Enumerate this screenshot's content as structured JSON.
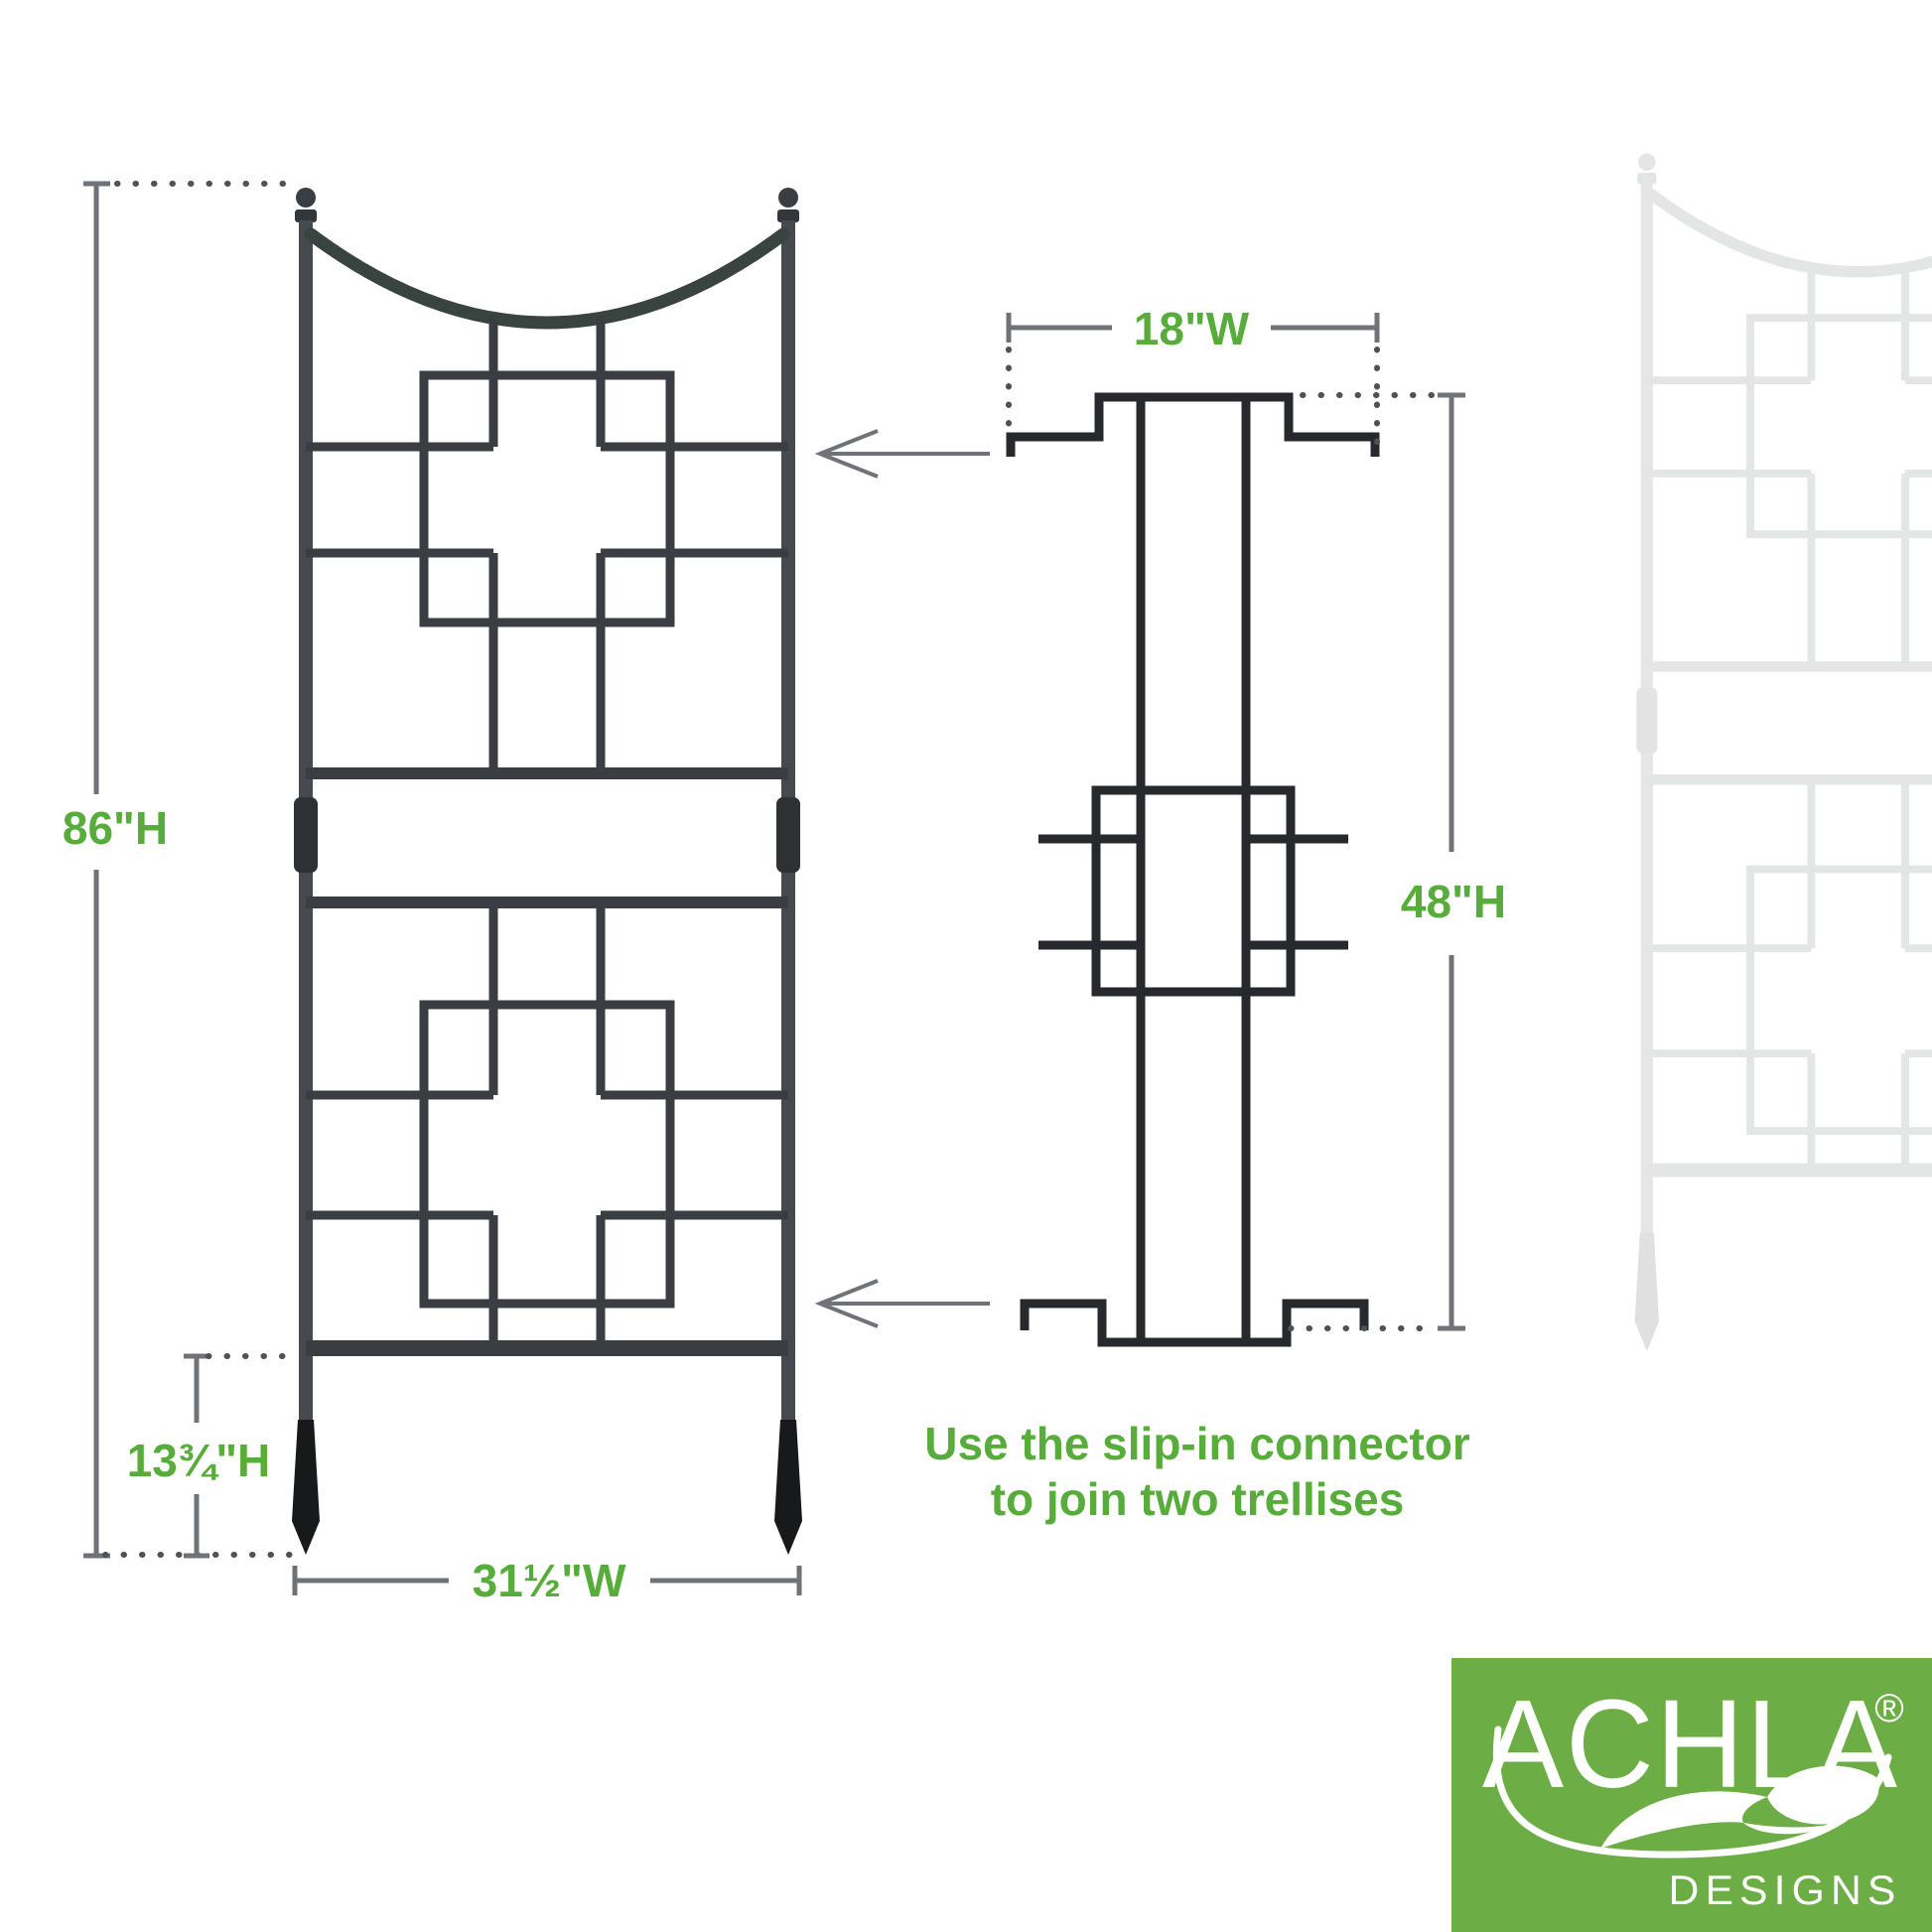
{
  "dimensions": {
    "total_height": "86\"H",
    "stake_height": "13¾\"H",
    "width": "31½\"W",
    "connector_width": "18\"W",
    "connector_height": "48\"H"
  },
  "note": {
    "line1": "Use the slip-in connector",
    "line2": "to join two trellises"
  },
  "logo": {
    "brand": "ACHLA",
    "registered": "®",
    "subtitle": "DESIGNS"
  },
  "colors": {
    "label_green": "#58ac3b",
    "logo_green": "#6dad45",
    "metal_dark": "#3a3e42",
    "metal_black": "#1a1c1e",
    "connector_dark": "#27292c",
    "dim_gray": "#6f7377",
    "curve_tint": "#394440",
    "background": "#ffffff"
  }
}
